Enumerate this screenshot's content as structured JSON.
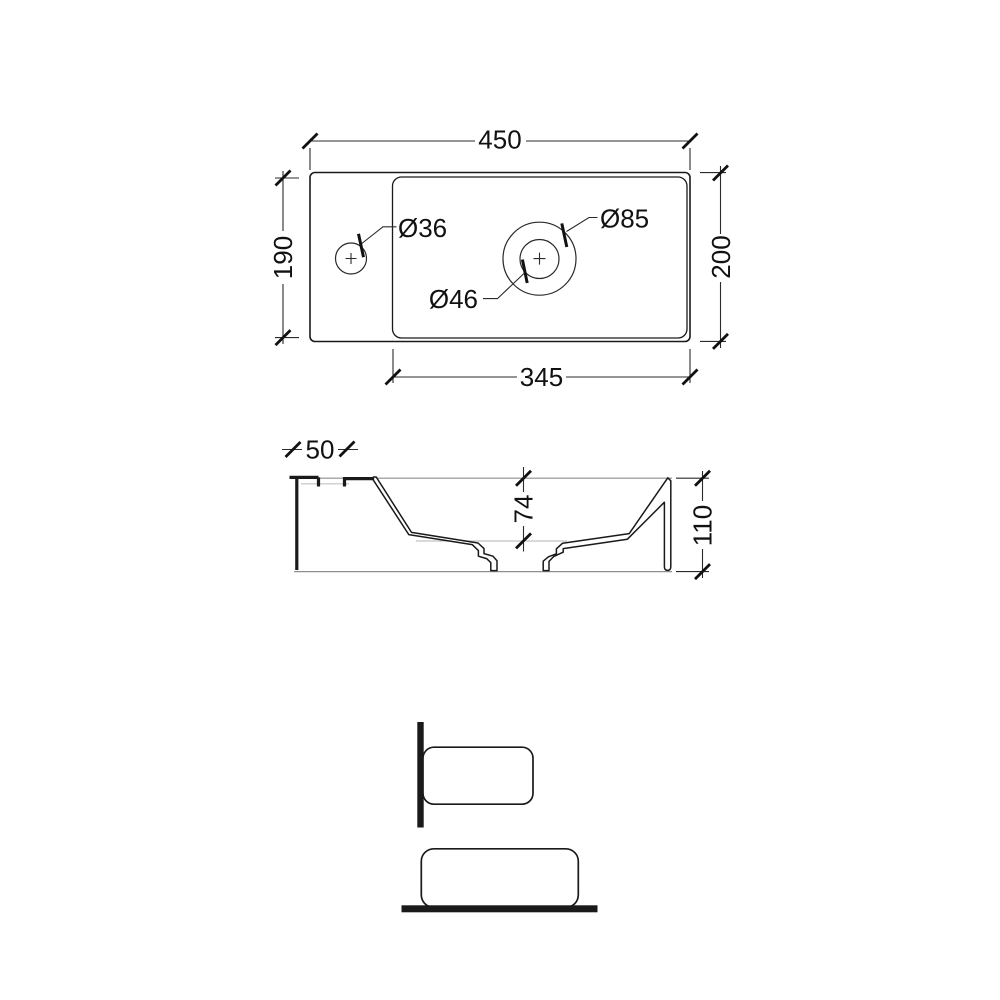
{
  "top_view": {
    "overall_width": "450",
    "overall_depth": "200",
    "bowl_width": "345",
    "bowl_depth": "190",
    "tap_hole_diameter": "Ø36",
    "waste_hole_diameter": "Ø46",
    "waste_recess_diameter": "Ø85"
  },
  "section_view": {
    "fixing_slot_width": "50",
    "bowl_inner_depth": "74",
    "overall_height": "110"
  },
  "colors": {
    "line": "#1a1a1a",
    "dimension_line": "#2b2b2b",
    "hidden_line": "#c2c2c2",
    "section_boundary": "#8f8f8f",
    "background": "#ffffff"
  }
}
